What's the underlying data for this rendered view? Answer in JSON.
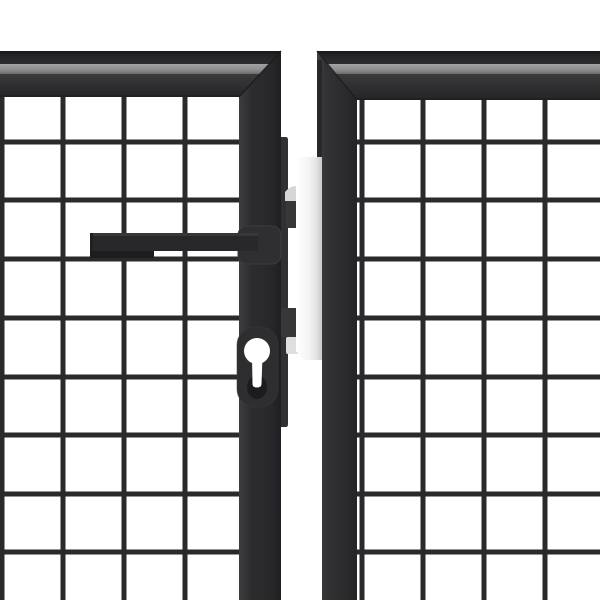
{
  "scene": {
    "description": "Close-up product photo of an anthracite grey steel double garden gate: two leaves with square wire-mesh infill and thick box-section frames, a horizontal bar handle and euro-profile keyhole on the left leaf, and a white lock post plate in the gap between the leaves.",
    "background_color": "#ffffff"
  },
  "colors": {
    "background": "#ffffff",
    "frame-base": "#2c2c2e",
    "frame-highlight": "#3d3d40",
    "frame-shadow": "#1f1f22",
    "frame-top-edge": "#18181a",
    "rail-gray-light": "#a3a3a3",
    "rail-gray-dark": "#6b6b6b",
    "mesh-wire": "#2a2a2c",
    "lockcase": "#303033",
    "tab": "#37373a",
    "plate-light": "#ffffff",
    "plate-shade": "#c8c8c8",
    "bracket-gray": "#d6d6d6",
    "handle-dark": "#28282a",
    "handle-top": "#3a3a3d",
    "handle-under": "#1d1d1f",
    "keyhole-recess": "#1c1c1e"
  },
  "gate": {
    "panels": 2,
    "mesh_wire_thickness": 5,
    "left_panel": {
      "mesh_area": {
        "left": 0,
        "right": 239,
        "top": 97,
        "bottom": 600
      },
      "mesh_vertical_wires_x": [
        2,
        63,
        124,
        185
      ],
      "mesh_horizontal_wires_y": [
        142,
        200,
        259,
        318,
        377,
        435,
        494,
        552
      ]
    },
    "right_panel": {
      "mesh_area": {
        "left": 357,
        "right": 600,
        "top": 100,
        "bottom": 600
      },
      "mesh_vertical_wires_x": [
        362,
        423,
        484,
        545
      ],
      "mesh_horizontal_wires_y": [
        142,
        200,
        259,
        318,
        377,
        435,
        494,
        552
      ]
    },
    "hardware": {
      "handle": "horizontal-bar-handle",
      "lock": "euro-profile-keyhole",
      "center_post": "white-lock-plate"
    }
  }
}
